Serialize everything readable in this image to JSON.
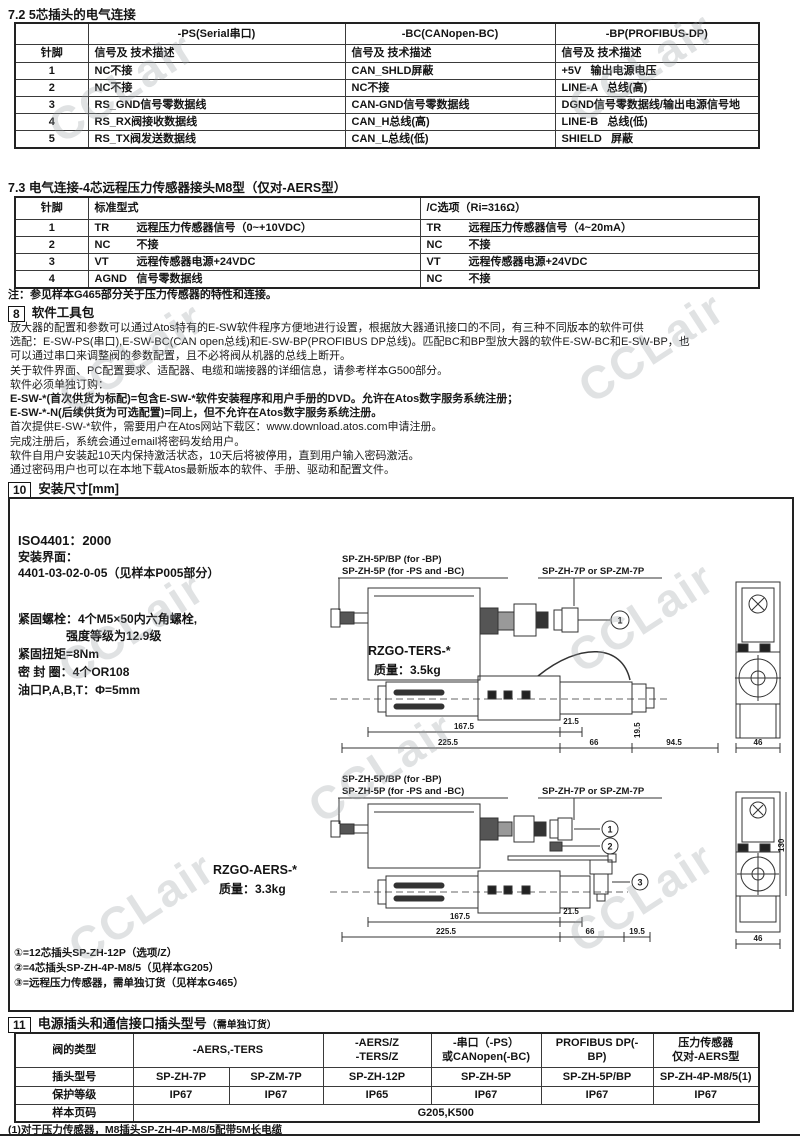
{
  "watermark": "CCLair",
  "sec72": {
    "title": "7.2  5芯插头的电气连接",
    "pin_header": "针脚",
    "desc_header": "信号及 技术描述",
    "cols": [
      "-PS(Serial串口)",
      "-BC(CANopen-BC)",
      "-BP(PROFIBUS-DP)"
    ],
    "rows": [
      {
        "pin": "1",
        "ps": "NC不接",
        "bc": "CAN_SHLD屏蔽",
        "bp": "+5V   输出电源电压"
      },
      {
        "pin": "2",
        "ps": "NC不接",
        "bc": "NC不接",
        "bp": "LINE-A   总线(高)"
      },
      {
        "pin": "3",
        "ps": "RS_GND信号零数据线",
        "bc": "CAN-GND信号零数据线",
        "bp": "DGND信号零数据线/输出电源信号地"
      },
      {
        "pin": "4",
        "ps": "RS_RX阀接收数据线",
        "bc": "CAN_H总线(高)",
        "bp": "LINE-B   总线(低)"
      },
      {
        "pin": "5",
        "ps": "RS_TX阀发送数据线",
        "bc": "CAN_L总线(低)",
        "bp": "SHIELD   屏蔽"
      }
    ]
  },
  "sec73": {
    "title": "7.3  电气连接-4芯远程压力传感器接头M8型（仅对-AERS型）",
    "pin_header": "针脚",
    "std_header": "标准型式",
    "opt_header": "/C选项（Ri=316Ω）",
    "rows": [
      {
        "pin": "1",
        "std_code": "TR",
        "std_desc": "远程压力传感器信号（0~+10VDC）",
        "opt_code": "TR",
        "opt_desc": "远程压力传感器信号（4~20mA）"
      },
      {
        "pin": "2",
        "std_code": "NC",
        "std_desc": "不接",
        "opt_code": "NC",
        "opt_desc": "不接"
      },
      {
        "pin": "3",
        "std_code": "VT",
        "std_desc": "远程传感器电源+24VDC",
        "opt_code": "VT",
        "opt_desc": "远程传感器电源+24VDC"
      },
      {
        "pin": "4",
        "std_code": "AGND",
        "std_desc": "信号零数据线",
        "opt_code": "NC",
        "opt_desc": "不接"
      }
    ],
    "note": "注：参见样本G465部分关于压力传感器的特性和连接。"
  },
  "sec8": {
    "num": "8",
    "title": "软件工具包",
    "lines": [
      "放大器的配置和参数可以通过Atos特有的E-SW软件程序方便地进行设置，根据放大器通讯接口的不同，有三种不同版本的软件可供",
      "选配：E-SW-PS(串口),E-SW-BC(CAN open总线)和E-SW-BP(PROFIBUS DP总线)。匹配BC和BP型放大器的软件E-SW-BC和E-SW-BP，也",
      "可以通过串口来调整阀的参数配置，且不必将阀从机器的总线上断开。",
      "关于软件界面、PC配置要求、适配器、电缆和端接器的详细信息，请参考样本G500部分。",
      "软件必须单独订购：",
      "E-SW-*(首次供货为标配)=包含E-SW-*软件安装程序和用户手册的DVD。允许在Atos数字服务系统注册；",
      "E-SW-*-N(后续供货为可选配置)=同上，但不允许在Atos数字服务系统注册。",
      "首次提供E-SW-*软件，需要用户在Atos网站下载区：www.download.atos.com申请注册。",
      "完成注册后，系统会通过email将密码发给用户。",
      "软件自用户安装起10天内保持激活状态，10天后将被停用，直到用户输入密码激活。",
      "通过密码用户也可以在本地下载Atos最新版本的软件、手册、驱动和配置文件。"
    ]
  },
  "sec10": {
    "num": "10",
    "title": "安装尺寸[mm]",
    "iso": "ISO4401：2000",
    "interface_label": "安装界面：",
    "interface_value": "4401-03-02-0-05（见样本P005部分）",
    "bolts1": "紧固螺栓：4个M5×50内六角螺栓,",
    "bolts2": "强度等级为12.9级",
    "torque": "紧固扭矩=8Nm",
    "seals": "密 封 圈：4个OR108",
    "ports": "油口P,A,B,T：Φ=5mm",
    "model1_name": "RZGO-TERS-*",
    "model1_weight": "质量：3.5kg",
    "model2_name": "RZGO-AERS-*",
    "model2_weight": "质量：3.3kg",
    "label_bp": "SP-ZH-5P/BP (for -BP)",
    "label_psbc": "SP-ZH-5P (for -PS and -BC)",
    "label_7p": "SP-ZH-7P or SP-ZM-7P",
    "dim_1675": "167.5",
    "dim_2255": "225.5",
    "dim_215": "21.5",
    "dim_66": "66",
    "dim_945": "94.5",
    "dim_195": "19.5",
    "dim_46": "46",
    "dim_130": "130",
    "callout1": "1",
    "callout2": "2",
    "callout3": "3",
    "notes": [
      "①=12芯插头SP-ZH-12P（选项/Z）",
      "②=4芯插头SP-ZH-4P-M8/5（见样本G205）",
      "③=远程压力传感器，需单独订货（见样本G465）"
    ]
  },
  "sec11": {
    "num": "11",
    "title": "电源插头和通信接口插头型号",
    "title_note": "（需单独订货）",
    "type_label": "阀的类型",
    "group1": "-AERS,-TERS",
    "group2a": "-AERS/Z",
    "group2b": "-TERS/Z",
    "group3a": "-串口（-PS）",
    "group3b": "或CANopen(-BC)",
    "group4": "PROFIBUS DP(-BP)",
    "group5a": "压力传感器",
    "group5b": "仅对-AERS型",
    "plug_label": "插头型号",
    "plugs": [
      "SP-ZH-7P",
      "SP-ZM-7P",
      "SP-ZH-12P",
      "SP-ZH-5P",
      "SP-ZH-5P/BP",
      "SP-ZH-4P-M8/5(1)"
    ],
    "ip_label": "保护等级",
    "ips": [
      "IP67",
      "IP67",
      "IP65",
      "IP67",
      "IP67",
      "IP67"
    ],
    "page_label": "样本页码",
    "page_value": "G205,K500",
    "footnote": "(1)对于压力传感器，M8插头SP-ZH-4P-M8/5配带5M长电缆"
  }
}
